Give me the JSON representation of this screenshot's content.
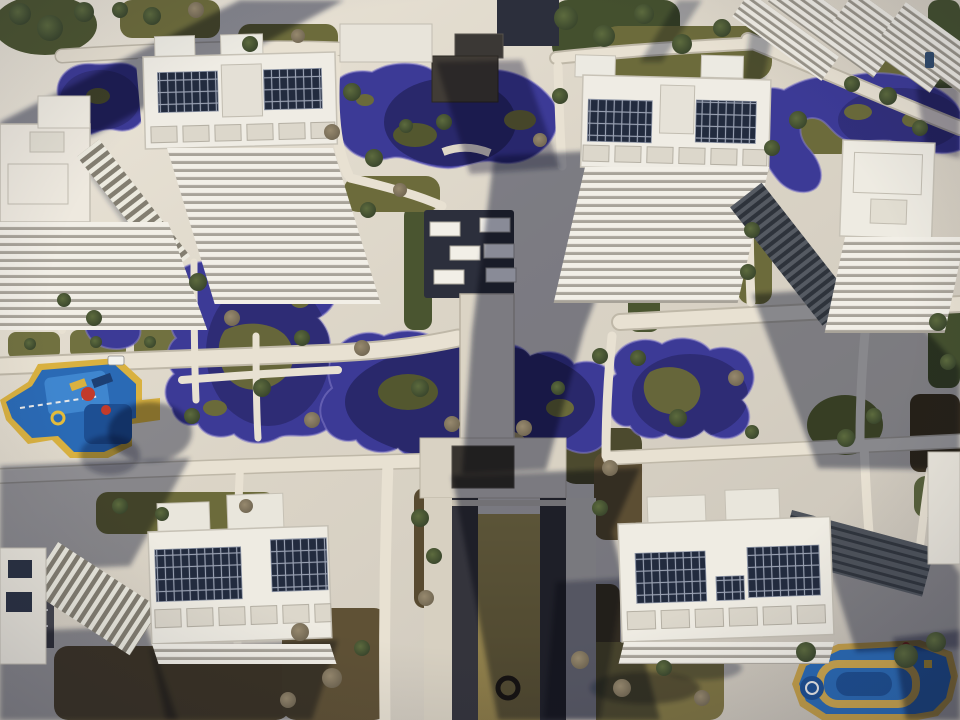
{
  "scene": {
    "label": "Aerial drone view of a residential complex: white high-rise towers with rooftop solar panel arrays around landscaped courtyards, winding deep blue ornamental ponds with planted islands, light stone pathways, a central axis walkway with pergola plaza and fountain ring, two blue-and-yellow children's playgrounds, and long winter shadows falling across pale pavement.",
    "type": "aerial-photograph",
    "no_visible_text": true
  },
  "palette": {
    "pavement": "#d7d0c2",
    "pavement_shaded": "#9a97a2",
    "pond": "#3c3a96",
    "pond_deep": "#1d1d4e",
    "pond_fringe": "#837bc8",
    "greenery": "#6c6b3b",
    "greenery_dark": "#3f4b2b",
    "soil": "#5f5135",
    "lawn": "#97874f",
    "roof": "#efece4",
    "facade_light": "#f2efe7",
    "facade_gap": "#a8a399",
    "solar_panel": "#222b3e",
    "solar_frame": "#99a1b2",
    "playground_blue": "#2a6ab5",
    "playground_blue_dark": "#1d4f93",
    "playground_yellow": "#d9b140",
    "equipment_red": "#c23b2b",
    "equipment_navy": "#1c3f74",
    "shadow": "#232a4e",
    "dark_plaza": "#2c2f3c"
  },
  "features": {
    "towers_with_solar_arrays": 4,
    "partial_edge_buildings": 5,
    "ponds": 6,
    "playgrounds": 2,
    "pergola_canopies": 6,
    "pavilions": 2,
    "fountain_rings": 1
  }
}
